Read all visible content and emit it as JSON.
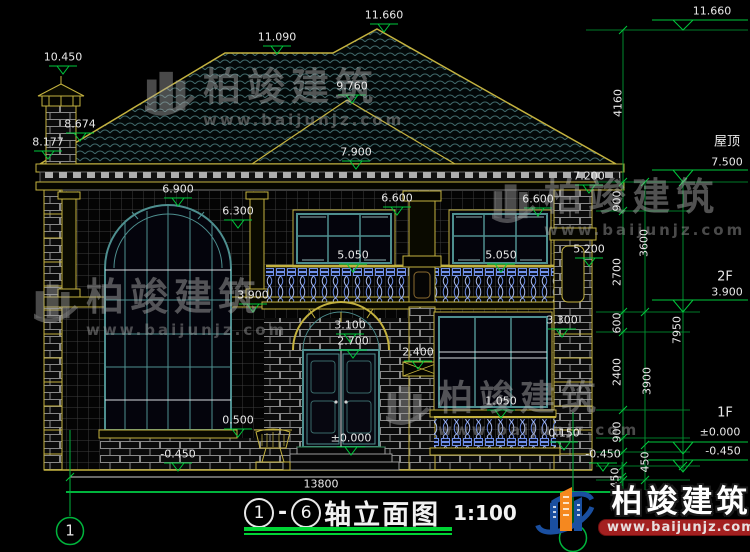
{
  "drawing": {
    "name": "house-front-elevation",
    "total_width_dim": "13800",
    "axis_bubble_left": "1"
  },
  "title": {
    "axis_start": "1",
    "separator": "-",
    "axis_end": "6",
    "text": "轴立面图",
    "scale": "1:100"
  },
  "watermark": {
    "brand": "柏竣建筑",
    "url": "www.baijunjz.com"
  },
  "logo": {
    "brand": "柏竣建筑",
    "url": "www.baijunjz.com"
  },
  "colors": {
    "cad_yellow": "#c4b23f",
    "frame_teal": "#4e8f8f",
    "dim_green": "#00c83c",
    "axis_green": "#00b43c",
    "text_white": "#e8e8e8",
    "baluster_blue": "#6f8fe8",
    "logo_blue": "#1a4fa0",
    "logo_orange": "#f5881f",
    "banner_red": "#a32020"
  },
  "annotations": [
    {
      "t": "10.450",
      "x": 63,
      "y": 57,
      "m": 1
    },
    {
      "t": "11.090",
      "x": 277,
      "y": 37,
      "m": 1
    },
    {
      "t": "11.660",
      "x": 384,
      "y": 15,
      "m": 1
    },
    {
      "t": "11.660",
      "x": 712,
      "y": 11
    },
    {
      "t": "9.760",
      "x": 352,
      "y": 86,
      "m": 1
    },
    {
      "t": "8.674",
      "x": 80,
      "y": 124,
      "m": 1
    },
    {
      "t": "8.177",
      "x": 48,
      "y": 142,
      "m": 1
    },
    {
      "t": "7.900",
      "x": 356,
      "y": 152,
      "m": 1
    },
    {
      "t": "7.200",
      "x": 589,
      "y": 176,
      "m": 1
    },
    {
      "t": "屋顶",
      "x": 727,
      "y": 142,
      "s": 13
    },
    {
      "t": "7.500",
      "x": 727,
      "y": 162
    },
    {
      "t": "6.900",
      "x": 178,
      "y": 189,
      "m": 1
    },
    {
      "t": "6.600",
      "x": 397,
      "y": 198,
      "m": 1
    },
    {
      "t": "6.600",
      "x": 538,
      "y": 199,
      "m": 1
    },
    {
      "t": "6.300",
      "x": 238,
      "y": 211,
      "m": 1
    },
    {
      "t": "5.050",
      "x": 353,
      "y": 255,
      "m": 1
    },
    {
      "t": "5.050",
      "x": 501,
      "y": 255,
      "m": 1
    },
    {
      "t": "5.200",
      "x": 589,
      "y": 249,
      "m": 1
    },
    {
      "t": "2F",
      "x": 725,
      "y": 277,
      "s": 13
    },
    {
      "t": "3.900",
      "x": 727,
      "y": 292
    },
    {
      "t": "3.900",
      "x": 253,
      "y": 295,
      "m": 1
    },
    {
      "t": "3.300",
      "x": 562,
      "y": 320,
      "m": 1
    },
    {
      "t": "3.100",
      "x": 350,
      "y": 325,
      "m": 1
    },
    {
      "t": "2.700",
      "x": 353,
      "y": 341,
      "m": 1
    },
    {
      "t": "2.400",
      "x": 418,
      "y": 352,
      "m": 1
    },
    {
      "t": "1.050",
      "x": 501,
      "y": 401,
      "m": 1
    },
    {
      "t": "0.500",
      "x": 238,
      "y": 420,
      "m": 1
    },
    {
      "t": "0.150",
      "x": 564,
      "y": 433,
      "m": 1
    },
    {
      "t": "±0.000",
      "x": 351,
      "y": 438,
      "m": 1
    },
    {
      "t": "1F",
      "x": 725,
      "y": 413,
      "s": 13
    },
    {
      "t": "±0.000",
      "x": 720,
      "y": 432
    },
    {
      "t": "-0.450",
      "x": 723,
      "y": 451
    },
    {
      "t": "-0.450",
      "x": 178,
      "y": 454,
      "m": 1
    },
    {
      "t": "-0.450",
      "x": 603,
      "y": 454,
      "m": 1
    },
    {
      "t": "13800",
      "x": 321,
      "y": 484
    },
    {
      "t": "4160",
      "x": 618,
      "y": 103,
      "r": 1
    },
    {
      "t": "900",
      "x": 617,
      "y": 201,
      "r": 1
    },
    {
      "t": "3600",
      "x": 644,
      "y": 243,
      "r": 1
    },
    {
      "t": "2700",
      "x": 617,
      "y": 272,
      "r": 1
    },
    {
      "t": "600",
      "x": 617,
      "y": 323,
      "r": 1
    },
    {
      "t": "7950",
      "x": 677,
      "y": 330,
      "r": 1
    },
    {
      "t": "2400",
      "x": 617,
      "y": 372,
      "r": 1
    },
    {
      "t": "3900",
      "x": 647,
      "y": 381,
      "r": 1
    },
    {
      "t": "900",
      "x": 617,
      "y": 432,
      "r": 1
    },
    {
      "t": "450",
      "x": 645,
      "y": 462,
      "r": 1
    },
    {
      "t": "450",
      "x": 615,
      "y": 478,
      "r": 1
    },
    {
      "t": "1",
      "x": 70,
      "y": 531,
      "s": 15,
      "n": "axis-bubble-number"
    }
  ]
}
